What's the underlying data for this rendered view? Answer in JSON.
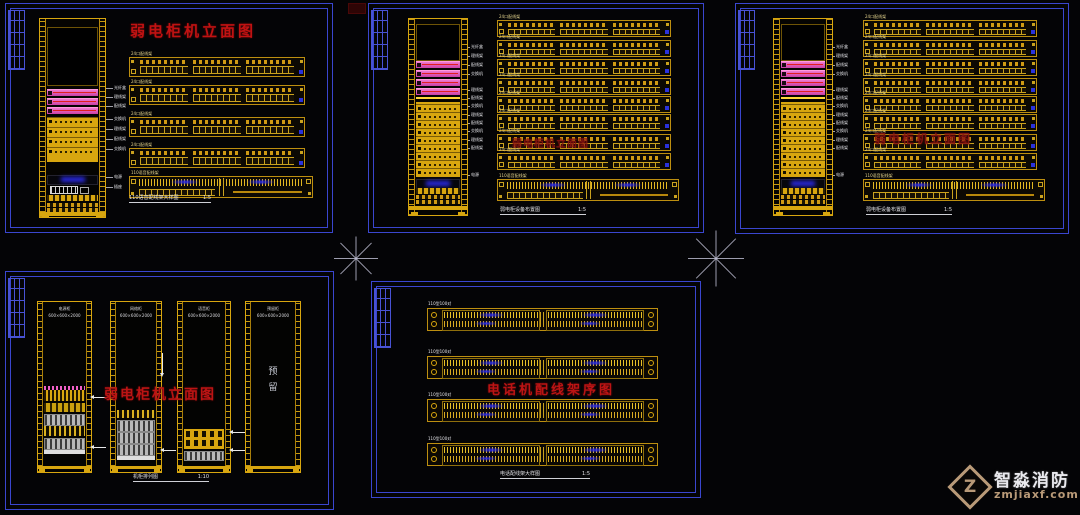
{
  "colors": {
    "frame_blue": "#3a46cf",
    "grid_blue": "#4852d4",
    "cad_yellow": "#d8a60f",
    "bright_yellow": "#e8c028",
    "pink": "#ee6cc8",
    "red_line": "#e02020",
    "title_red": "#bc1414",
    "dim_red": "#8a1410",
    "blue_glow": "#2b2bec",
    "white": "#e6e6ea",
    "watermark_tan": "#b99a78"
  },
  "watermark": {
    "brand": "智淼消防",
    "domain": "zmjiaxf.com",
    "logo_letter": "Z"
  },
  "panels": {
    "p1": {
      "title": "弱电柜机立面图",
      "caption": "110语音配线架大样图",
      "scale": "1:5",
      "patch_labels": [
        "24口配线架",
        "24口配线架",
        "24口配线架",
        "24口配线架"
      ],
      "block_label": "110语音配线架",
      "leader_labels": [
        "光纤盒",
        "理线架",
        "配线架",
        "交换机",
        "理线架",
        "配线架",
        "交换机",
        "电源",
        "插座"
      ]
    },
    "p2": {
      "title_dim": "弱电柜机立面图",
      "caption": "弱电柜设备布置图",
      "scale": "1:5",
      "patch_labels": [
        "24口配线架",
        "24口配线架",
        "24口配线架",
        "24口配线架",
        "24口配线架",
        "24口配线架",
        "24口配线架",
        "24口配线架"
      ],
      "block_label": "110语音配线架",
      "leader_labels": [
        "光纤盒",
        "理线架",
        "配线架",
        "交换机",
        "理线架",
        "配线架",
        "交换机",
        "理线架",
        "配线架",
        "交换机",
        "理线架",
        "配线架",
        "电源"
      ]
    },
    "p3": {
      "title_dim": "弱电柜机立面图",
      "caption": "弱电柜设备布置图",
      "scale": "1:5",
      "patch_labels": [
        "24口配线架",
        "24口配线架",
        "24口配线架",
        "24口配线架",
        "24口配线架",
        "24口配线架",
        "24口配线架",
        "24口配线架"
      ],
      "block_label": "110语音配线架",
      "leader_labels": [
        "光纤盒",
        "理线架",
        "配线架",
        "交换机",
        "理线架",
        "配线架",
        "交换机",
        "理线架",
        "配线架",
        "交换机",
        "理线架",
        "配线架",
        "电源"
      ]
    },
    "p4": {
      "title": "弱电柜机立面图",
      "caption": "机柜排列图",
      "scale": "1:10",
      "racks": [
        {
          "name": "电源柜",
          "dims": "600×600×2000"
        },
        {
          "name": "网络柜",
          "dims": "600×600×2000"
        },
        {
          "name": "语音柜",
          "dims": "600×600×2000"
        },
        {
          "name": "预留柜",
          "dims": "600×600×2000"
        }
      ],
      "reserved_label": "预留"
    },
    "p5": {
      "title": "电话机配线架序图",
      "caption": "电话配线架大样图",
      "scale": "1:5",
      "block_labels": [
        "110型100对",
        "110型100对",
        "110型100对",
        "110型100对"
      ]
    }
  }
}
